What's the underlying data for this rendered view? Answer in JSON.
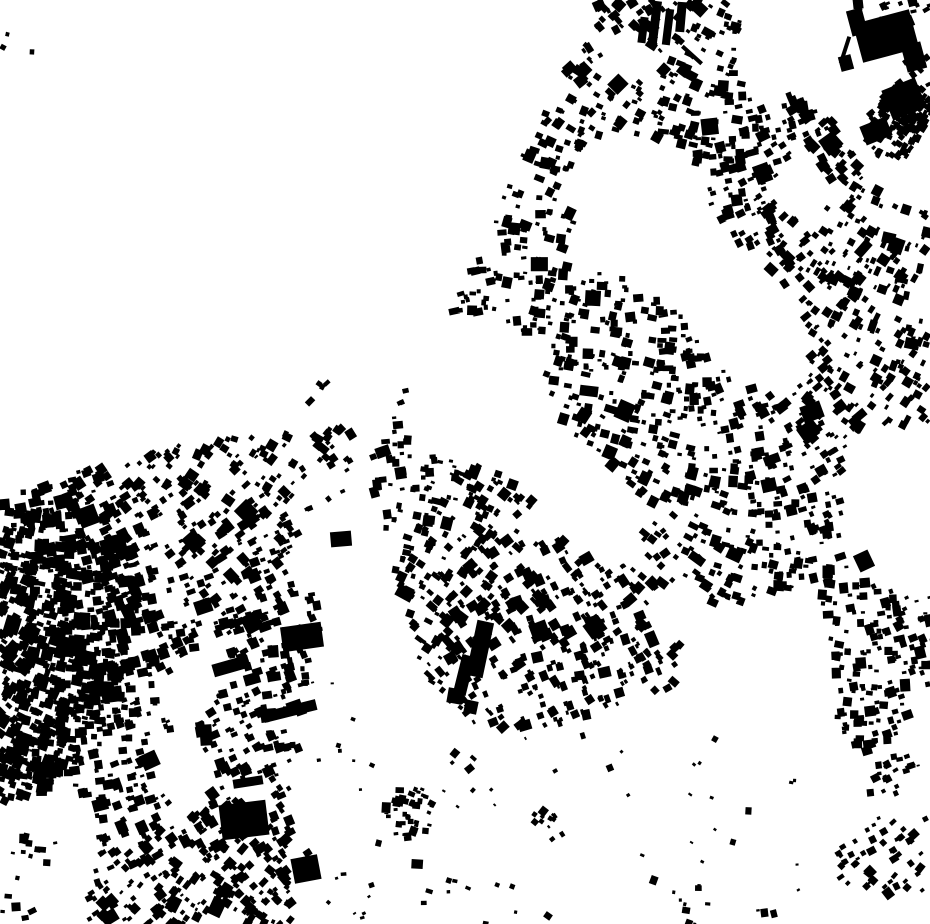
{
  "canvas": {
    "width": 930,
    "height": 924
  },
  "colors": {
    "background": "#ffffff",
    "building": "#000000"
  },
  "map": {
    "kind": "figure-ground-building-footprints",
    "seed": 1337,
    "noise": {
      "fa": 0.021,
      "fb": 0.019,
      "fc": 0.013,
      "fd": 0.016,
      "w1": 0.5,
      "w2": 0.3,
      "w3": 0.2
    },
    "angle_field": {
      "amp_x": 38,
      "amp_y": 30,
      "fx": 0.009,
      "fy": 0.008,
      "jitter": 13
    },
    "regions": [
      {
        "name": "main-urban-mass",
        "polygon": [
          [
            600,
            0
          ],
          [
            930,
            0
          ],
          [
            930,
            722
          ],
          [
            862,
            757
          ],
          [
            816,
            695
          ],
          [
            752,
            712
          ],
          [
            692,
            686
          ],
          [
            636,
            696
          ],
          [
            576,
            722
          ],
          [
            506,
            731
          ],
          [
            452,
            716
          ],
          [
            427,
            682
          ],
          [
            408,
            624
          ],
          [
            392,
            566
          ],
          [
            374,
            508
          ],
          [
            371,
            456
          ],
          [
            392,
            410
          ],
          [
            425,
            355
          ],
          [
            462,
            290
          ],
          [
            497,
            210
          ],
          [
            535,
            130
          ],
          [
            566,
            64
          ]
        ],
        "attempts": 6200,
        "accept": 0.62,
        "noise_cut": -0.2,
        "smin": 4,
        "smax": 11,
        "big_p": 0.06,
        "angle_bias": 0
      },
      {
        "name": "west-settlement-cluster",
        "polygon": [
          [
            0,
            478
          ],
          [
            80,
            468
          ],
          [
            170,
            447
          ],
          [
            252,
            436
          ],
          [
            355,
            427
          ],
          [
            351,
            470
          ],
          [
            335,
            524
          ],
          [
            321,
            585
          ],
          [
            311,
            646
          ],
          [
            303,
            706
          ],
          [
            295,
            776
          ],
          [
            289,
            846
          ],
          [
            293,
            924
          ],
          [
            0,
            924
          ]
        ],
        "attempts": 2800,
        "accept": 0.58,
        "noise_cut": -0.45,
        "smin": 4,
        "smax": 11,
        "big_p": 0.05,
        "angle_bias": -12
      },
      {
        "name": "west-dense-core",
        "polygon": [
          [
            0,
            495
          ],
          [
            55,
            486
          ],
          [
            112,
            504
          ],
          [
            142,
            554
          ],
          [
            136,
            624
          ],
          [
            114,
            700
          ],
          [
            84,
            762
          ],
          [
            40,
            796
          ],
          [
            0,
            802
          ]
        ],
        "attempts": 950,
        "accept": 0.85,
        "noise_cut": -0.85,
        "smin": 5,
        "smax": 12,
        "big_p": 0.04,
        "angle_bias": -15
      },
      {
        "name": "south-sparse-scatter",
        "polygon": [
          [
            362,
            706
          ],
          [
            450,
            726
          ],
          [
            540,
            736
          ],
          [
            620,
            716
          ],
          [
            700,
            696
          ],
          [
            780,
            726
          ],
          [
            842,
            772
          ],
          [
            902,
            762
          ],
          [
            930,
            736
          ],
          [
            930,
            924
          ],
          [
            298,
            924
          ],
          [
            304,
            762
          ]
        ],
        "attempts": 1500,
        "accept": 0.05,
        "noise_cut": -1,
        "smin": 3,
        "smax": 8,
        "big_p": 0.02,
        "angle_bias": 0
      }
    ],
    "voids": [
      {
        "cx": 627,
        "cy": 55,
        "r": 26
      },
      {
        "cx": 800,
        "cy": 190,
        "r": 28
      },
      {
        "cx": 764,
        "cy": 82,
        "r": 22
      },
      {
        "cx": 678,
        "cy": 612,
        "r": 32
      },
      {
        "cx": 903,
        "cy": 478,
        "r": 46
      },
      {
        "cx": 546,
        "cy": 522,
        "r": 22
      },
      {
        "cx": 185,
        "cy": 772,
        "r": 30
      },
      {
        "cx": 60,
        "cy": 902,
        "r": 28
      }
    ],
    "clusters": [
      {
        "cx": 905,
        "cy": 108,
        "r": 26,
        "attempts": 150,
        "accept": 0.75,
        "smin": 4,
        "smax": 9
      },
      {
        "cx": 892,
        "cy": 130,
        "r": 30,
        "attempts": 110,
        "accept": 0.55,
        "smin": 4,
        "smax": 9
      },
      {
        "cx": 410,
        "cy": 812,
        "r": 26,
        "attempts": 60,
        "accept": 0.6,
        "smin": 4,
        "smax": 9
      },
      {
        "cx": 545,
        "cy": 820,
        "r": 14,
        "attempts": 18,
        "accept": 0.6,
        "smin": 4,
        "smax": 8
      },
      {
        "cx": 880,
        "cy": 858,
        "r": 42,
        "attempts": 95,
        "accept": 0.5,
        "smin": 4,
        "smax": 10
      },
      {
        "cx": 893,
        "cy": 772,
        "r": 22,
        "attempts": 30,
        "accept": 0.5,
        "smin": 4,
        "smax": 9
      },
      {
        "cx": 250,
        "cy": 868,
        "r": 45,
        "attempts": 115,
        "accept": 0.5,
        "smin": 4,
        "smax": 10
      },
      {
        "cx": 35,
        "cy": 858,
        "r": 28,
        "attempts": 40,
        "accept": 0.5,
        "smin": 4,
        "smax": 9
      },
      {
        "cx": 120,
        "cy": 893,
        "r": 30,
        "attempts": 22,
        "accept": 0.35,
        "smin": 3,
        "smax": 8
      },
      {
        "cx": 180,
        "cy": 910,
        "r": 28,
        "attempts": 22,
        "accept": 0.4,
        "smin": 3,
        "smax": 8
      },
      {
        "cx": 10,
        "cy": 62,
        "r": 32,
        "attempts": 8,
        "accept": 0.5,
        "smin": 3,
        "smax": 7
      },
      {
        "cx": 325,
        "cy": 398,
        "r": 22,
        "attempts": 6,
        "accept": 0.55,
        "smin": 5,
        "smax": 9
      },
      {
        "cx": 332,
        "cy": 660,
        "r": 35,
        "attempts": 10,
        "accept": 0.35,
        "smin": 3,
        "smax": 7
      },
      {
        "cx": 690,
        "cy": 893,
        "r": 25,
        "attempts": 12,
        "accept": 0.4,
        "smin": 3,
        "smax": 7
      },
      {
        "cx": 480,
        "cy": 900,
        "r": 40,
        "attempts": 13,
        "accept": 0.35,
        "smin": 3,
        "smax": 7
      },
      {
        "cx": 350,
        "cy": 918,
        "r": 30,
        "attempts": 10,
        "accept": 0.4,
        "smin": 3,
        "smax": 7
      },
      {
        "cx": 903,
        "cy": 640,
        "r": 35,
        "attempts": 40,
        "accept": 0.5,
        "smin": 4,
        "smax": 9
      }
    ],
    "landmarks": [
      {
        "cx": 886,
        "cy": 36,
        "w": 58,
        "h": 40,
        "a": -15
      },
      {
        "cx": 857,
        "cy": 22,
        "w": 16,
        "h": 26,
        "a": -15
      },
      {
        "cx": 914,
        "cy": 57,
        "w": 20,
        "h": 27,
        "a": -15
      },
      {
        "cx": 846,
        "cy": 63,
        "w": 13,
        "h": 15,
        "a": -15
      },
      {
        "cx": 904,
        "cy": 99,
        "w": 36,
        "h": 32,
        "a": -22
      },
      {
        "cx": 876,
        "cy": 131,
        "w": 28,
        "h": 20,
        "a": -22
      },
      {
        "cx": 845,
        "cy": 50,
        "w": 4,
        "h": 28,
        "a": 18
      },
      {
        "cx": 692,
        "cy": 55,
        "w": 26,
        "h": 4,
        "a": 42
      },
      {
        "cx": 655,
        "cy": 22,
        "w": 9,
        "h": 42,
        "a": 7
      },
      {
        "cx": 668,
        "cy": 27,
        "w": 8,
        "h": 36,
        "a": 7
      },
      {
        "cx": 681,
        "cy": 17,
        "w": 9,
        "h": 30,
        "a": 5
      },
      {
        "cx": 643,
        "cy": 30,
        "w": 8,
        "h": 26,
        "a": 7
      },
      {
        "cx": 480,
        "cy": 649,
        "w": 17,
        "h": 56,
        "a": 12
      },
      {
        "cx": 464,
        "cy": 675,
        "w": 13,
        "h": 40,
        "a": 14
      },
      {
        "cx": 455,
        "cy": 696,
        "w": 15,
        "h": 15,
        "a": 10
      },
      {
        "cx": 471,
        "cy": 707,
        "w": 13,
        "h": 13,
        "a": 12
      },
      {
        "cx": 302,
        "cy": 637,
        "w": 41,
        "h": 25,
        "a": -8
      },
      {
        "cx": 231,
        "cy": 666,
        "w": 37,
        "h": 13,
        "a": -16
      },
      {
        "cx": 252,
        "cy": 679,
        "w": 16,
        "h": 11,
        "a": -16
      },
      {
        "cx": 206,
        "cy": 735,
        "w": 12,
        "h": 21,
        "a": -4
      },
      {
        "cx": 248,
        "cy": 782,
        "w": 30,
        "h": 9,
        "a": -9
      },
      {
        "cx": 290,
        "cy": 711,
        "w": 54,
        "h": 11,
        "a": -14
      },
      {
        "cx": 244,
        "cy": 820,
        "w": 47,
        "h": 35,
        "a": -7
      },
      {
        "cx": 306,
        "cy": 869,
        "w": 27,
        "h": 25,
        "a": -11
      },
      {
        "cx": 341,
        "cy": 539,
        "w": 21,
        "h": 15,
        "a": -5
      },
      {
        "cx": 812,
        "cy": 412,
        "w": 21,
        "h": 17,
        "a": -20
      },
      {
        "cx": 864,
        "cy": 561,
        "w": 16,
        "h": 18,
        "a": -25
      }
    ]
  }
}
